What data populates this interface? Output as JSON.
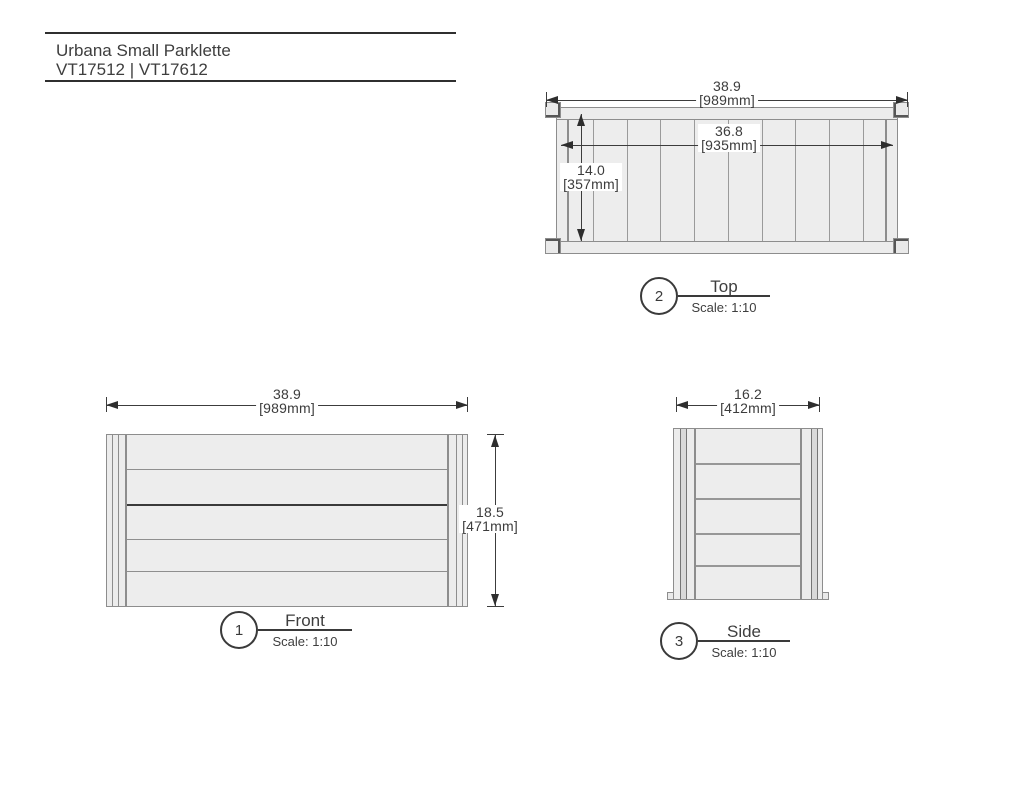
{
  "title_block": {
    "product_name": "Urbana Small Parklette",
    "sku_line": "VT17512 | VT17612"
  },
  "views": {
    "front": {
      "number": "1",
      "name": "Front",
      "scale_label": "Scale: 1:10",
      "board_count": 5,
      "dim_width": {
        "imperial": "38.9",
        "metric": "[989mm]"
      },
      "dim_height": {
        "imperial": "18.5",
        "metric": "[471mm]"
      }
    },
    "top": {
      "number": "2",
      "name": "Top",
      "scale_label": "Scale: 1:10",
      "slat_count": 10,
      "dim_width": {
        "imperial": "38.9",
        "metric": "[989mm]"
      },
      "dim_inner_width": {
        "imperial": "36.8",
        "metric": "[935mm]"
      },
      "dim_depth": {
        "imperial": "14.0",
        "metric": "[357mm]"
      }
    },
    "side": {
      "number": "3",
      "name": "Side",
      "scale_label": "Scale: 1:10",
      "board_count": 5,
      "dim_width": {
        "imperial": "16.2",
        "metric": "[412mm]"
      }
    }
  },
  "colors": {
    "drawing_line": "#8d8d8d",
    "drawing_fill": "#ededed",
    "dark_accent": "#3a3a3a",
    "dimension": "#3c3c3c",
    "text": "#3e3e3e"
  }
}
